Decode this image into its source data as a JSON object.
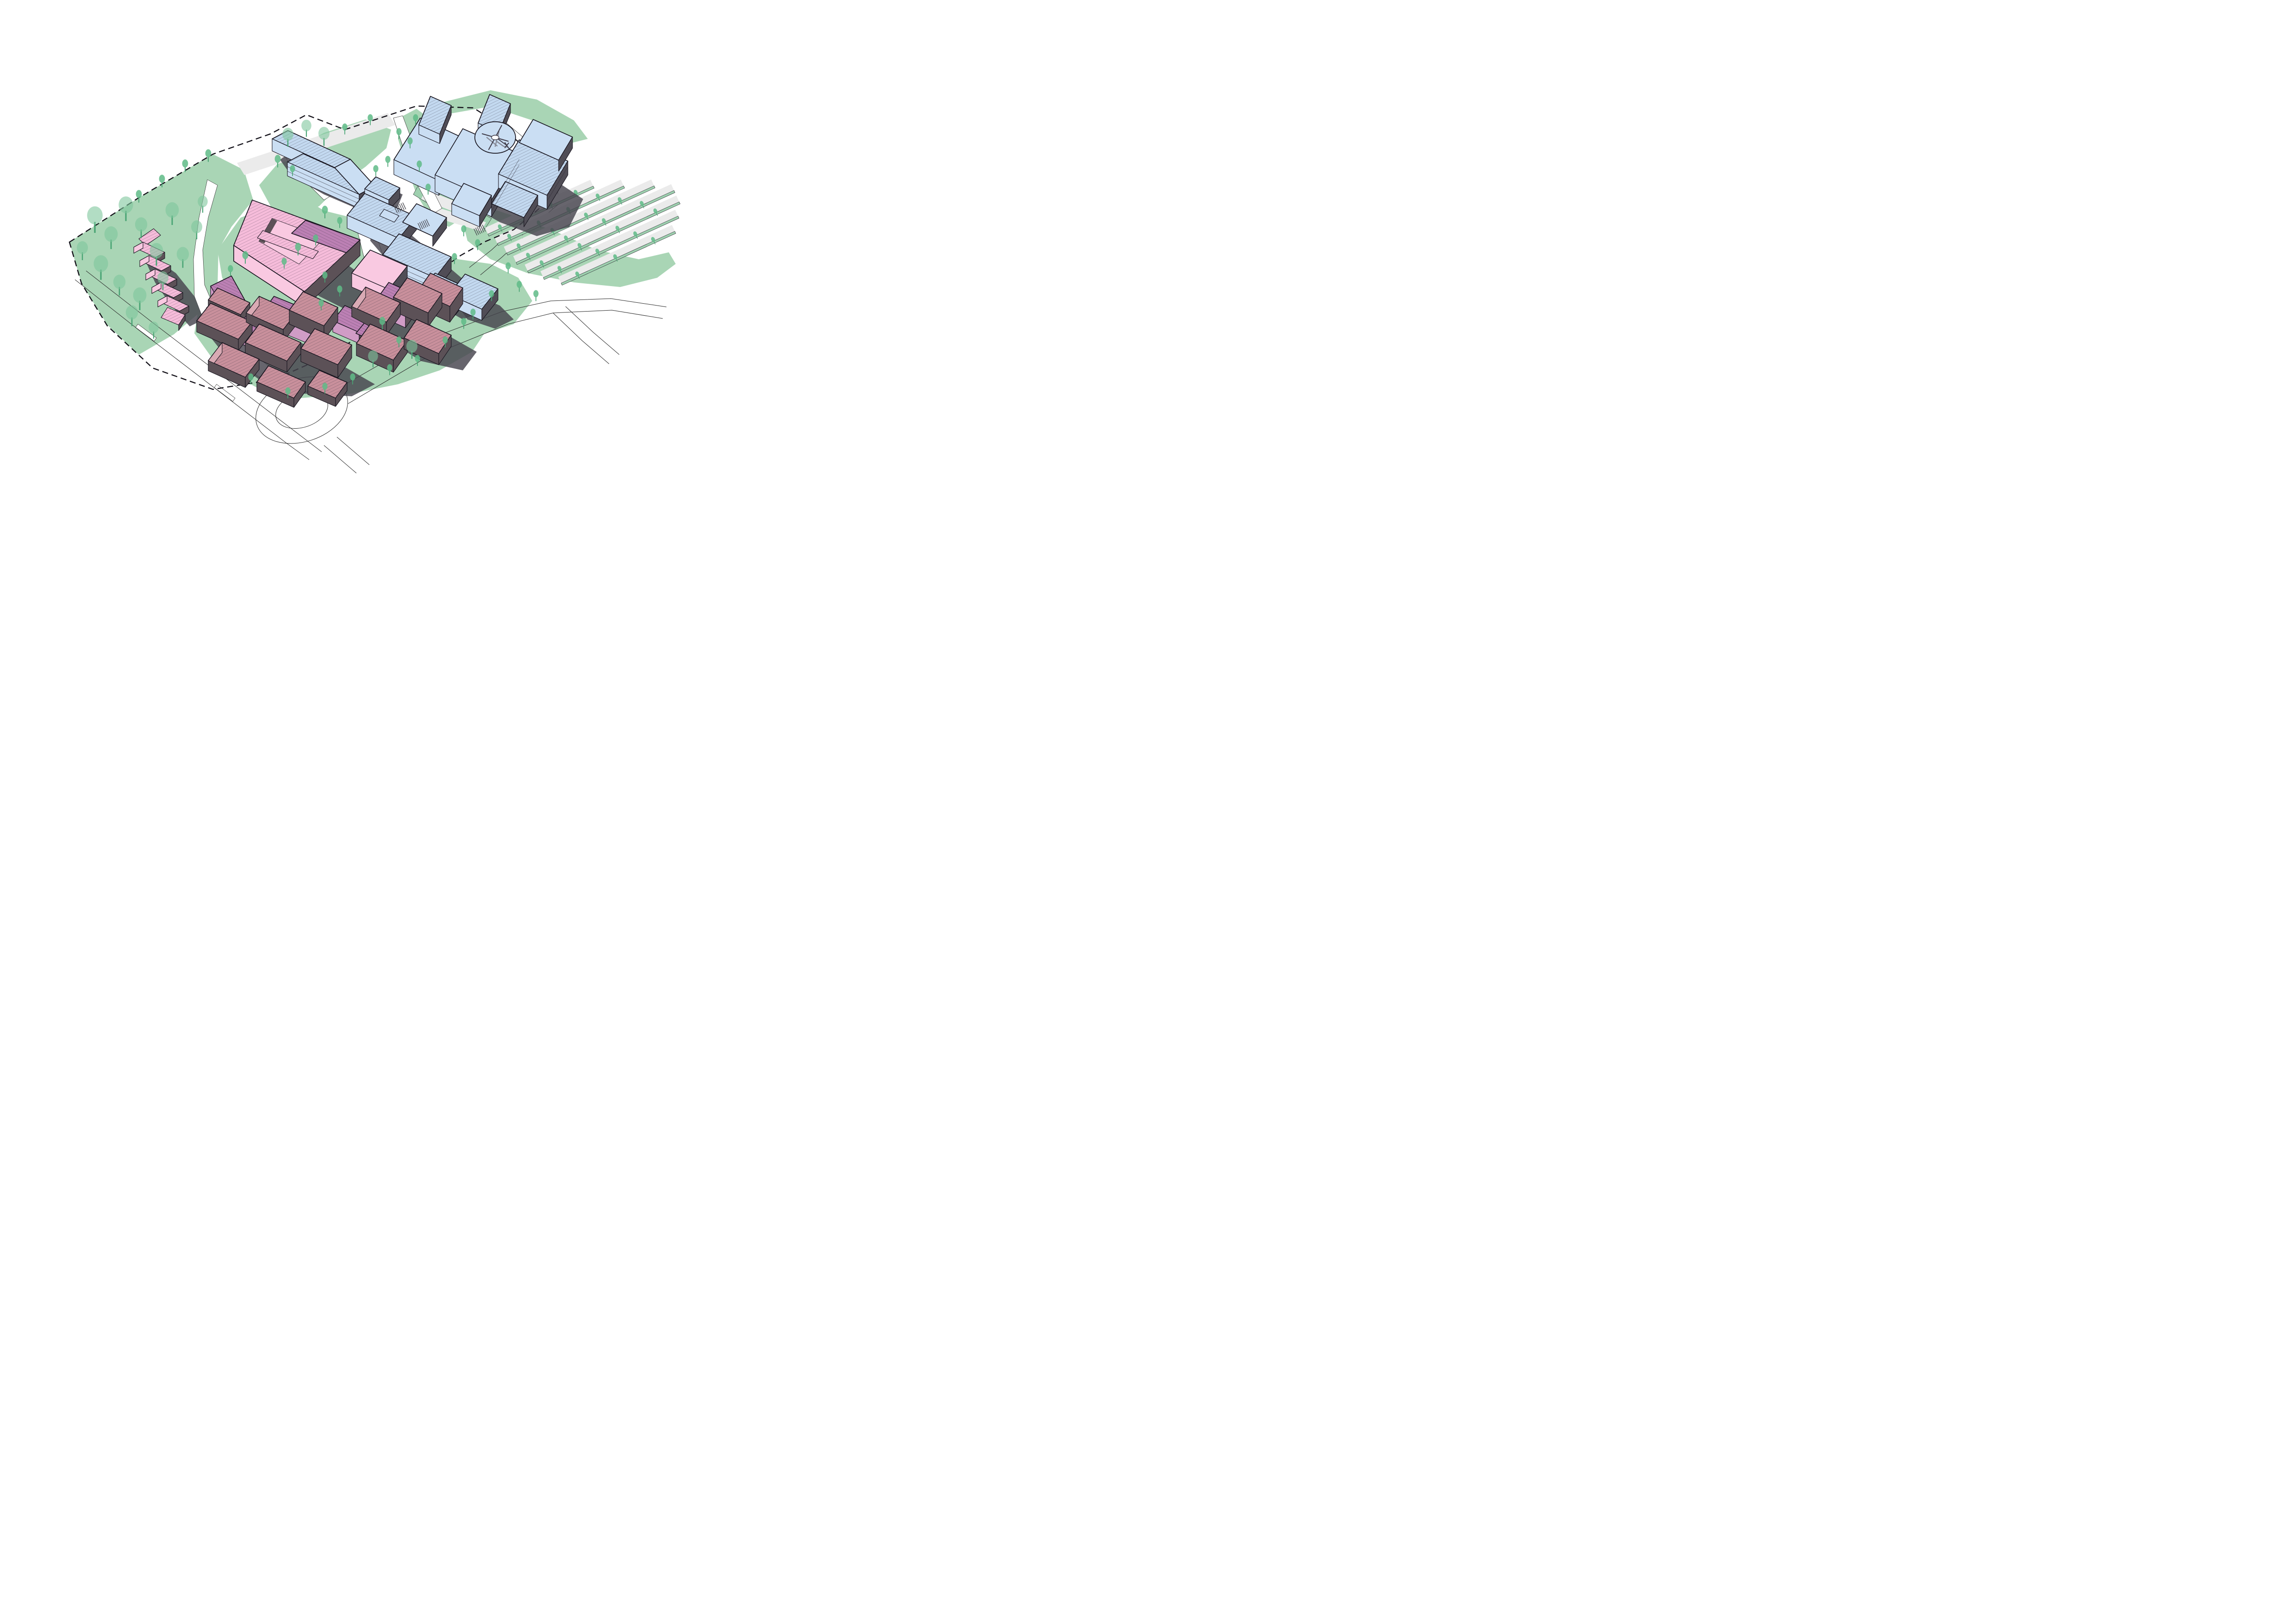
{
  "meta": {
    "diagram_type": "axonometric-campus-masterplan",
    "style": "illustrated-3d-site-plan",
    "text_labels": []
  },
  "colors": {
    "background": "#ffffff",
    "site_green": "#a9d5b5",
    "verge_green": "#9ed0af",
    "tree_green": "#5fbb87",
    "tree_green_light": "#7ec79c",
    "tree_trunk": "#49a474",
    "blue_building": "#cadef3",
    "blue_roof": "#c3d9f0",
    "pink_building": "#f9c9e1",
    "pink_roof": "#f6bcda",
    "purple_roof": "#bc80b4",
    "purple_wall_light": "#d09cc6",
    "mauve_roof": "#c9909c",
    "mauve_wall_light": "#d9aab4",
    "dark_wall_cool": "#504d56",
    "dark_wall_warm": "#5c5157",
    "cast_shadow": "#46434d",
    "road_gray": "#ebebeb",
    "outline": "#17141e",
    "hatch_line": "#2e2838",
    "road_line": "#2b2b2b",
    "boundary_line": "#14121a"
  },
  "site": {
    "boundary_style": "dashed",
    "clusters": [
      {
        "id": "hospital-building",
        "color_key": "blue_building",
        "features": [
          "helipad",
          "helicopter-icon"
        ]
      },
      {
        "id": "northwest-blue-building",
        "color_key": "blue_building"
      },
      {
        "id": "central-blue-buildings",
        "color_key": "blue_building"
      },
      {
        "id": "pink-courtyard-block",
        "color_key": "pink_building"
      },
      {
        "id": "purple-perimeter-blocks",
        "color_key": "purple_roof"
      },
      {
        "id": "pink-terrace-houses",
        "color_key": "pink_roof",
        "count": 6
      },
      {
        "id": "mauve-south-cluster",
        "color_key": "mauve_roof",
        "count": 9
      },
      {
        "id": "mauve-east-cluster",
        "color_key": "mauve_roof",
        "count": 5
      },
      {
        "id": "small-blue-gabled-building",
        "color_key": "blue_building"
      }
    ],
    "parking": {
      "rows": 7,
      "stall_color_key": "road_gray",
      "tree_islands": true
    },
    "roads": {
      "roundabout": true,
      "crosswalks": 3,
      "style": "outline-only"
    },
    "helipad": {
      "shape": "circle",
      "icon": "helicopter-icon"
    }
  }
}
